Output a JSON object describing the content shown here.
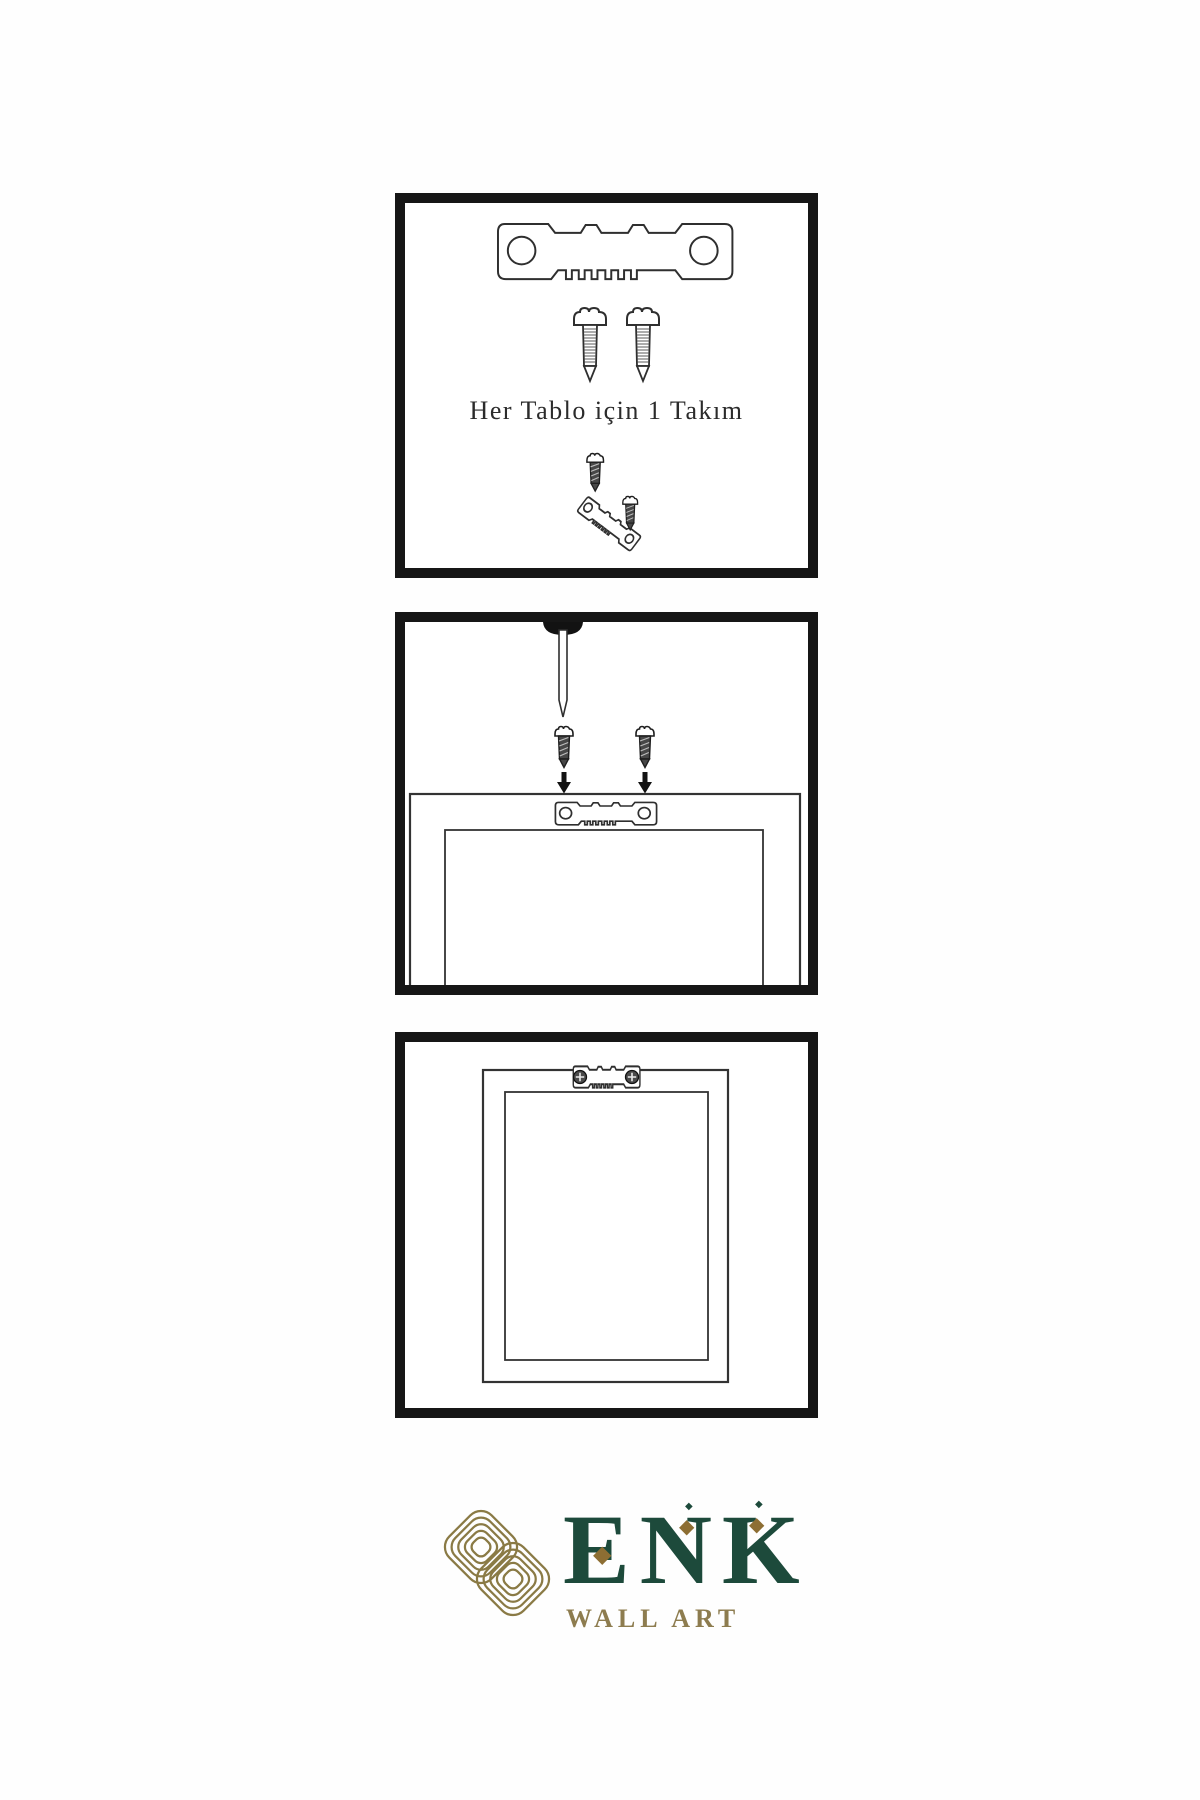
{
  "page": {
    "background": "#fefefe",
    "width": 1200,
    "height": 1800
  },
  "panels": [
    {
      "name": "hardware-kit",
      "caption": "Her Tablo için 1 Takım",
      "items": [
        "sawtooth-hanger",
        "screw",
        "screw",
        "screw-dark",
        "angled-sawtooth-hanger",
        "screw-dark"
      ]
    },
    {
      "name": "mounting-instructions",
      "items": [
        "wall-nail",
        "screw-dark",
        "screw-dark",
        "down-arrow",
        "down-arrow",
        "frame-back-outline",
        "sawtooth-hanger"
      ]
    },
    {
      "name": "hung-frame",
      "items": [
        "frame-front-outline",
        "mounted-sawtooth-hanger",
        "phillips-screw",
        "phillips-screw"
      ]
    }
  ],
  "logo": {
    "brand": "ENK",
    "subtitle": "WALL ART",
    "knot_icon": "interlocked-knot-icon",
    "diamond_icon": "diamond-accent-icon"
  },
  "colors": {
    "background": "#fefefe",
    "panel_border": "#161616",
    "line_art": "#2f2f2f",
    "screw_dark_fill": "#474747",
    "brand_green": "#1d4a3b",
    "brand_gold_knot": "#8a7a45",
    "diamond_gold": "#8d6e33",
    "subtitle_gold": "#8d7c4f"
  }
}
